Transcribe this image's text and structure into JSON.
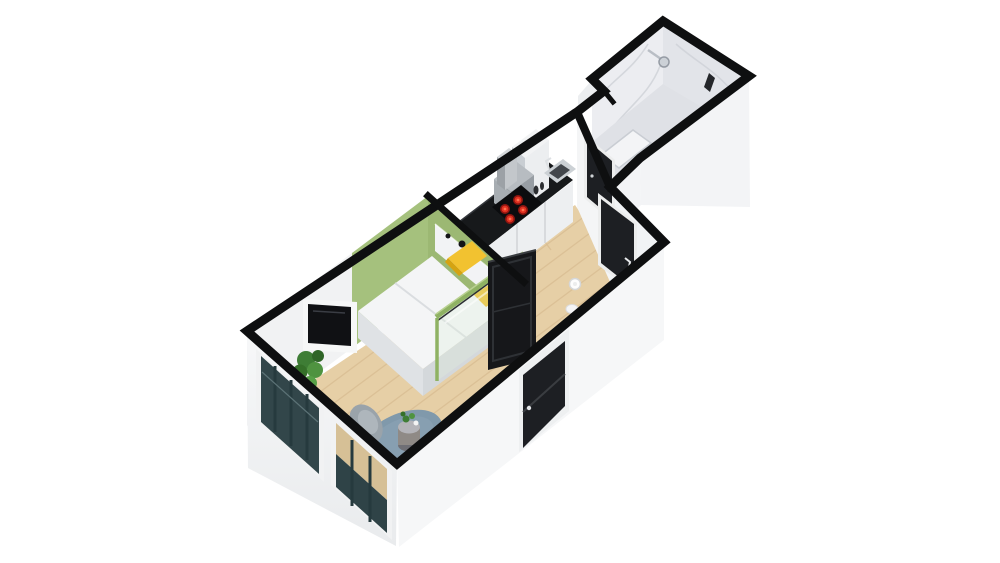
{
  "scene": {
    "type": "3d-floor-plan-render",
    "view": "isometric-top-down",
    "unit": "studio-apartment",
    "rooms": [
      {
        "name": "bedroom-living",
        "floor": "light-wood",
        "furniture": [
          "double-bed",
          "white-headboard",
          "yellow-pillows",
          "wall-tv",
          "potted-plant",
          "round-rug",
          "side-table-with-plant-and-cup",
          "lounge-chair",
          "glass-partition-green-frame",
          "black-sliding-door",
          "two-floor-windows"
        ]
      },
      {
        "name": "kitchen",
        "floor": "light-wood",
        "furniture": [
          "black-countertop",
          "cooktop-4-red-burners",
          "steel-sink",
          "white-base-cabinets",
          "tall-white-cabinet",
          "small-appliance",
          "gray-platform",
          "bottles"
        ]
      },
      {
        "name": "hallway",
        "floor": "light-wood",
        "furniture": [
          "ceiling-lamp-marker",
          "small-white-stool",
          "entry-door-dark",
          "bathroom-door-dark"
        ]
      },
      {
        "name": "bathroom",
        "floor": "marble-tile",
        "furniture": [
          "marble-walls",
          "walk-in-shower",
          "shower-head",
          "shower-tray",
          "dark-fixture"
        ]
      },
      {
        "name": "facade",
        "floor": null,
        "furniture": [
          "balcony-door-dark",
          "window-glass-panels"
        ]
      }
    ]
  },
  "palette": {
    "background": "#ffffff",
    "wall_line": "#0e0f10",
    "wall_white": "#f4f5f6",
    "wall_interior": "#f1f2f3",
    "green_wall": "#a5c17d",
    "green_partition": "#9cb873",
    "green_rail": "#8fb263",
    "wood_floor": "#e6cfa6",
    "wood_plank": "#d9be93",
    "marble": "#e9eaee",
    "marble_floor": "#dfe1e6",
    "rug": "#8099ab",
    "pillow": "#f2c230",
    "mattress": "#f4f5f6",
    "door_dark": "#1d1f23",
    "sliding_panel": "#16171a",
    "counter_black": "#17191b",
    "burner_red": "#e23222",
    "sink_basin": "#43474c",
    "window_glass": "#32464a",
    "window_glass_low": "#2f4347",
    "window_see_through": "#d6c096",
    "plant_green": "#3e7d35",
    "tv_black": "#101114",
    "table_gray": "#8f8a86",
    "chair_gray": "#9aa3aa",
    "cabinet_white": "#edeff1"
  }
}
